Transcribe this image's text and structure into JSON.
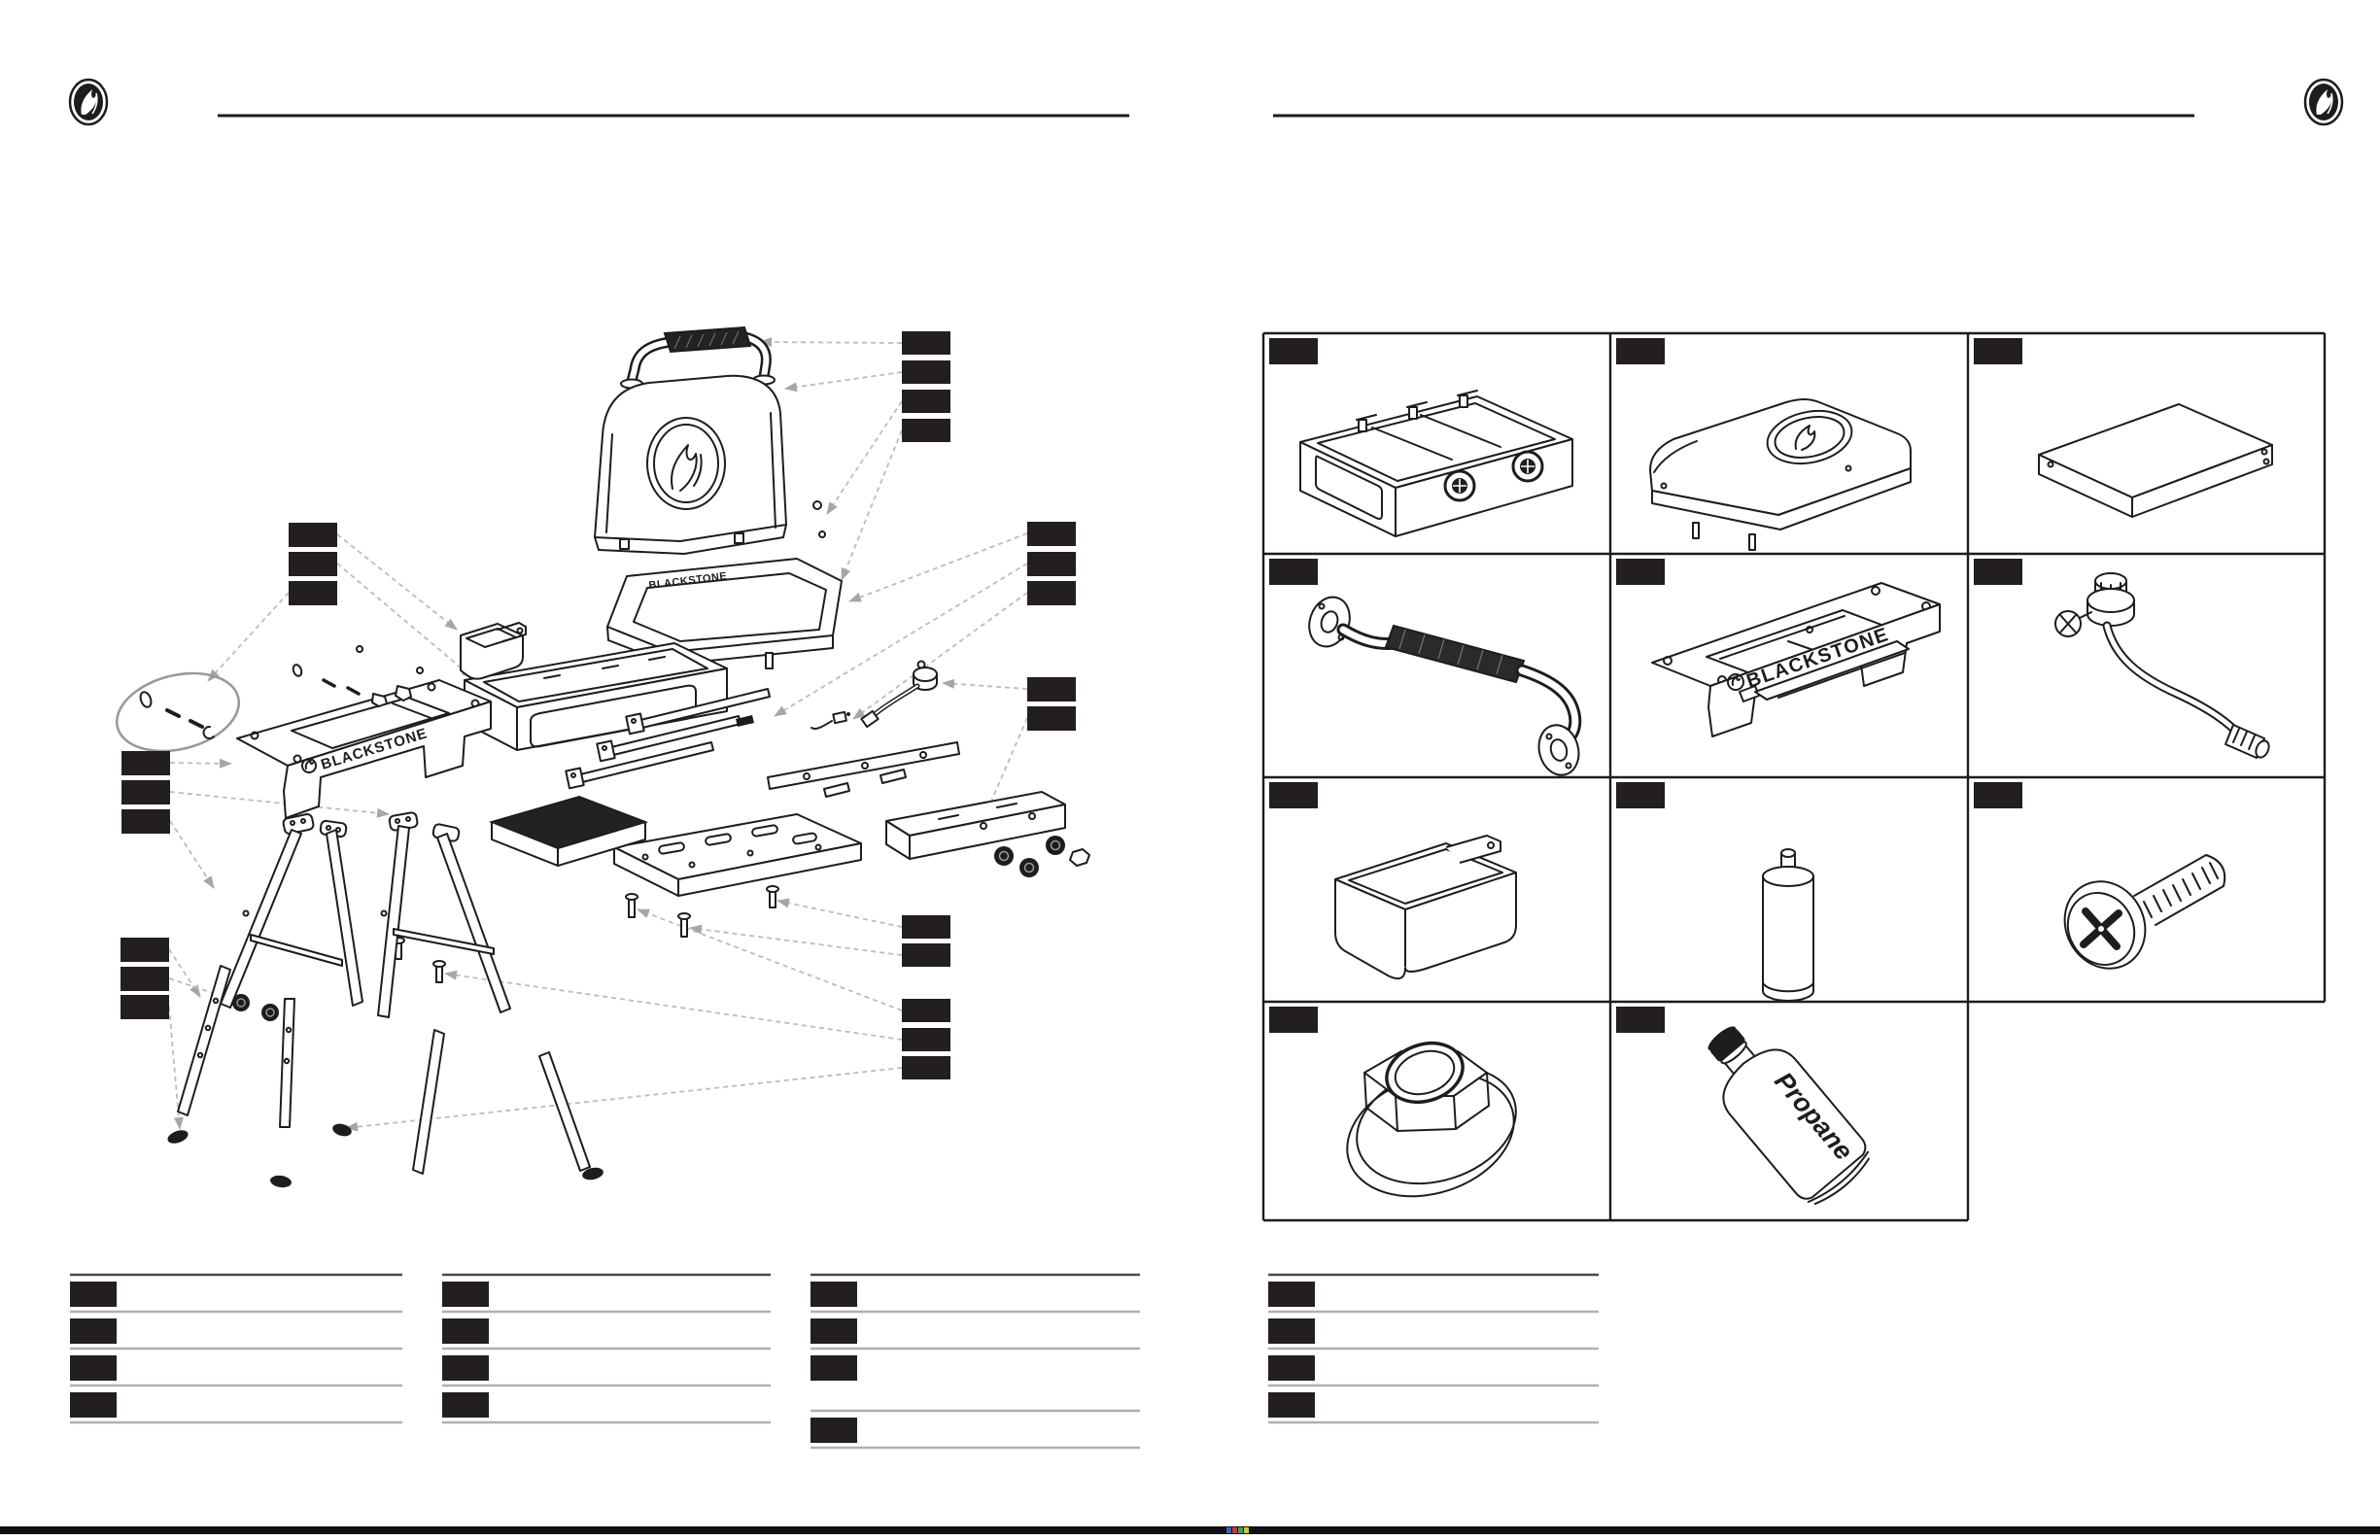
{
  "branding": {
    "logo_icon": "blackstone-flame-logo",
    "wordmark": "BLACKSTONE"
  },
  "texts": {
    "brand_wordmark": "BLACKSTONE",
    "propane_label": "Propane"
  },
  "left_page": {
    "content": "exploded-assembly-diagram-tabletop-griddle",
    "callout_groups": {
      "top_right_boxes": 4,
      "upper_left_boxes": 3,
      "mid_right_upper_boxes": 3,
      "mid_right_lower_boxes": 2,
      "mid_left_boxes": 3,
      "lower_left_boxes": 3,
      "bottom_right_upper_boxes": 2,
      "bottom_right_lower_boxes": 3
    },
    "legend_columns": [
      {
        "rows": 4
      },
      {
        "rows": 4
      },
      {
        "rows": 4
      }
    ]
  },
  "right_page": {
    "parts_grid": {
      "rows": 4,
      "columns": 3,
      "cells": [
        {
          "part": "burner-box-assembly"
        },
        {
          "part": "hood"
        },
        {
          "part": "griddle-top-plate"
        },
        {
          "part": "carry-handle"
        },
        {
          "part": "base-stand"
        },
        {
          "part": "regulator-with-hose"
        },
        {
          "part": "grease-cup"
        },
        {
          "part": "support-cylinder"
        },
        {
          "part": "phillips-screw"
        },
        {
          "part": "flange-nut"
        },
        {
          "part": "propane-bottle"
        }
      ]
    },
    "legend_rows": 4
  },
  "colors": {
    "ink": "#1d1d1f",
    "callout_box": "#231f20",
    "leader_line": "#bcbcbc",
    "legend_rule_dark": "#4a4a4a",
    "legend_rule_light": "#b0b0b0",
    "footer_bar": "#101010"
  }
}
